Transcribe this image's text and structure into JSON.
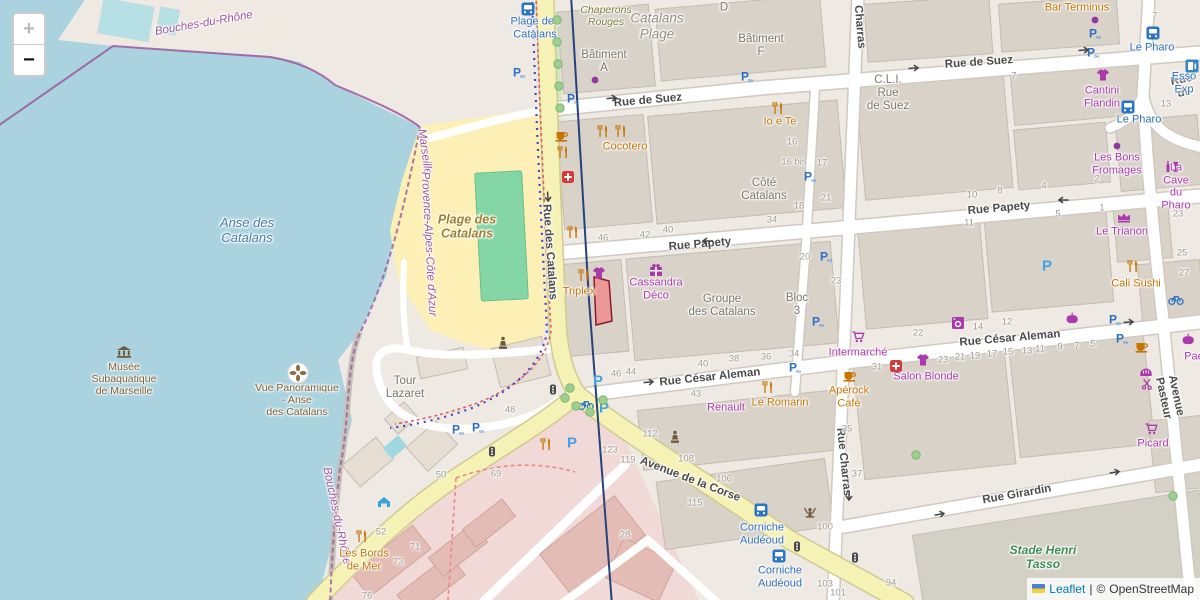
{
  "controls": {
    "zoom_in": "+",
    "zoom_out": "−"
  },
  "attribution": {
    "leaflet": "Leaflet",
    "separator": "|",
    "copyright": "©",
    "osm": "OpenStreetMap"
  },
  "colors": {
    "water": "#aad3df",
    "land": "#eeeae3",
    "building": "#d8d2c9",
    "beach": "#fdf0b6",
    "pitch": "#85d6a6",
    "road_yellow": "#f6f2b6",
    "road_white": "#ffffff",
    "residential_pink": "#f0d9d6",
    "boundary_purple": "#9b59a0",
    "poi_orange": "#c77400",
    "poi_purple": "#ac39ac",
    "parking_blue": "#2a6fc4",
    "bus_blue": "#2f6fc0",
    "highlight_red": "#e06a6a",
    "stadium_label_green": "#3e8e51"
  },
  "labels": [
    {
      "text": "Rue de Suez",
      "x": 648,
      "y": 101,
      "cls": "st",
      "rot": -5,
      "name": "street-label-rue-de-suez"
    },
    {
      "text": "Rue de Suez",
      "x": 979,
      "y": 63,
      "cls": "st",
      "rot": -4,
      "name": "street-label-rue-de-suez"
    },
    {
      "text": "Rue de",
      "x": 1183,
      "y": 87,
      "cls": "st",
      "rot": -12,
      "name": "street-label-rue-de"
    },
    {
      "text": "Rue Papety",
      "x": 700,
      "y": 245,
      "cls": "st",
      "rot": -5,
      "name": "street-label-rue-papety"
    },
    {
      "text": "Rue Papety",
      "x": 999,
      "y": 209,
      "cls": "st",
      "rot": -5,
      "name": "street-label-rue-papety"
    },
    {
      "text": "Rue César Aleman",
      "x": 710,
      "y": 378,
      "cls": "st",
      "rot": -6,
      "name": "street-label-rue-cesar-aleman"
    },
    {
      "text": "Rue César Aleman",
      "x": 1010,
      "y": 339,
      "cls": "st",
      "rot": -5,
      "name": "street-label-rue-cesar-aleman"
    },
    {
      "text": "Rue Girardin",
      "x": 1017,
      "y": 495,
      "cls": "st",
      "rot": -10,
      "name": "street-label-rue-girardin"
    },
    {
      "text": "Avenue de la Corse",
      "x": 690,
      "y": 480,
      "cls": "st",
      "rot": 21,
      "name": "street-label-avenue-de-la-corse"
    },
    {
      "text": "Rue des Catalans",
      "x": 549,
      "y": 252,
      "cls": "st",
      "rot": 86,
      "name": "street-label-rue-des-catalans"
    },
    {
      "text": "Rue Charras",
      "x": 843,
      "y": 462,
      "cls": "st",
      "rot": 84,
      "name": "street-label-rue-charras"
    },
    {
      "text": "Charras",
      "x": 859,
      "y": 27,
      "cls": "st",
      "rot": 85,
      "name": "street-label-charras"
    },
    {
      "text": "Avenue Pasteur",
      "x": 1169,
      "y": 397,
      "cls": "st",
      "rot": 78,
      "name": "street-label-avenue-pasteur"
    },
    {
      "text": "Plage des\nCatalans",
      "x": 535,
      "y": 28,
      "cls": "bus",
      "name": "bus-stop-label"
    },
    {
      "text": "Le Pharo",
      "x": 1152,
      "y": 48,
      "cls": "bus",
      "name": "bus-stop-label"
    },
    {
      "text": "Le Pharo",
      "x": 1139,
      "y": 120,
      "cls": "bus",
      "name": "bus-stop-label"
    },
    {
      "text": "Esso Exp",
      "x": 1184,
      "y": 83,
      "cls": "bus",
      "name": "fuel-station-label"
    },
    {
      "text": "Corniche\nAudéoud",
      "x": 762,
      "y": 534,
      "cls": "bus",
      "name": "bus-stop-label"
    },
    {
      "text": "Corniche\nAudéoud",
      "x": 780,
      "y": 577,
      "cls": "bus",
      "name": "bus-stop-label"
    },
    {
      "text": "Anse des\nCatalans",
      "x": 247,
      "y": 231,
      "cls": "wat",
      "name": "water-label"
    },
    {
      "text": "Bouches-du-Rhône",
      "x": 204,
      "y": 24,
      "cls": "bnd",
      "rot": -10,
      "name": "boundary-label"
    },
    {
      "text": "Marseille",
      "x": 424,
      "y": 152,
      "cls": "bnd",
      "rot": 82,
      "name": "boundary-label"
    },
    {
      "text": "Provence-Alpes-Côte d'Azur",
      "x": 428,
      "y": 244,
      "cls": "bnd",
      "rot": 87,
      "name": "boundary-label"
    },
    {
      "text": "Bouches-du-Rhône",
      "x": 336,
      "y": 516,
      "cls": "bnd",
      "rot": 78,
      "name": "boundary-label"
    },
    {
      "text": "Plage des\nCatalans",
      "x": 467,
      "y": 227,
      "cls": "bch",
      "name": "beach-label"
    },
    {
      "text": "Catalans\nPlage",
      "x": 657,
      "y": 26,
      "cls": "area",
      "name": "area-label"
    },
    {
      "text": "Chaperons\nRouges",
      "x": 606,
      "y": 16,
      "cls": "olv",
      "name": "area-label"
    },
    {
      "text": "Stade Henri\nTasso",
      "x": 1043,
      "y": 558,
      "cls": "grn",
      "name": "stadium-label"
    },
    {
      "text": "Bâtiment\nA",
      "x": 604,
      "y": 62,
      "cls": "bld",
      "name": "building-label"
    },
    {
      "text": "Bâtiment\nF",
      "x": 761,
      "y": 46,
      "cls": "bld",
      "name": "building-label"
    },
    {
      "text": "D",
      "x": 724,
      "y": 8,
      "cls": "bld",
      "name": "building-label"
    },
    {
      "text": "Côté\nCatalans",
      "x": 764,
      "y": 190,
      "cls": "bld",
      "name": "building-label"
    },
    {
      "text": "C.L.I.\nRue\nde Suez",
      "x": 888,
      "y": 94,
      "cls": "bld",
      "name": "building-label"
    },
    {
      "text": "Groupe\ndes Catalans",
      "x": 722,
      "y": 306,
      "cls": "bld",
      "name": "building-label"
    },
    {
      "text": "Bloc\n3",
      "x": 797,
      "y": 305,
      "cls": "bld",
      "name": "building-label"
    },
    {
      "text": "Tour\nLazaret",
      "x": 405,
      "y": 388,
      "cls": "bld",
      "name": "building-label"
    },
    {
      "text": "Musée\nSubaquatique\nde Marseille",
      "x": 124,
      "y": 379,
      "cls": "brw",
      "name": "museum-label"
    },
    {
      "text": "Vue Panoramique\n- Anse\ndes Catalans",
      "x": 297,
      "y": 400,
      "cls": "brw",
      "name": "viewpoint-label"
    },
    {
      "text": "Cocotero",
      "x": 625,
      "y": 147,
      "cls": "po",
      "name": "poi-label"
    },
    {
      "text": "Io e Te",
      "x": 780,
      "y": 122,
      "cls": "po",
      "name": "poi-label"
    },
    {
      "text": "Bar Terminus",
      "x": 1077,
      "y": 8,
      "cls": "po",
      "name": "poi-label"
    },
    {
      "text": "Triplex",
      "x": 579,
      "y": 292,
      "cls": "po",
      "name": "poi-label"
    },
    {
      "text": "Le Romarin",
      "x": 780,
      "y": 403,
      "cls": "po",
      "name": "poi-label"
    },
    {
      "text": "Apérock\nCafé",
      "x": 849,
      "y": 397,
      "cls": "po",
      "name": "poi-label"
    },
    {
      "text": "Les Bords\nde Mer",
      "x": 364,
      "y": 560,
      "cls": "po",
      "name": "poi-label"
    },
    {
      "text": "Cali Sushi",
      "x": 1136,
      "y": 284,
      "cls": "po",
      "name": "poi-label"
    },
    {
      "text": "Cantini\nFlandin",
      "x": 1102,
      "y": 97,
      "cls": "pp",
      "name": "poi-label"
    },
    {
      "text": "Les Bons\nFromages",
      "x": 1117,
      "y": 164,
      "cls": "pp",
      "name": "poi-label"
    },
    {
      "text": "La Cave\ndu Pharo",
      "x": 1176,
      "y": 187,
      "cls": "pp",
      "name": "poi-label"
    },
    {
      "text": "Le Trianon",
      "x": 1122,
      "y": 232,
      "cls": "pp",
      "name": "poi-label"
    },
    {
      "text": "Cassandra\nDéco",
      "x": 656,
      "y": 289,
      "cls": "pp",
      "name": "poi-label"
    },
    {
      "text": "Intermarché",
      "x": 858,
      "y": 353,
      "cls": "pp",
      "name": "poi-label"
    },
    {
      "text": "Salon Blonde",
      "x": 926,
      "y": 377,
      "cls": "pp",
      "name": "poi-label"
    },
    {
      "text": "Renault",
      "x": 726,
      "y": 408,
      "cls": "pp",
      "name": "poi-label"
    },
    {
      "text": "Picard",
      "x": 1153,
      "y": 444,
      "cls": "pp",
      "name": "poi-label"
    },
    {
      "text": "Paé",
      "x": 1194,
      "y": 357,
      "cls": "pp",
      "name": "poi-label"
    },
    {
      "text": "46",
      "x": 603,
      "y": 239,
      "cls": "num"
    },
    {
      "text": "42",
      "x": 645,
      "y": 236,
      "cls": "num"
    },
    {
      "text": "40",
      "x": 668,
      "y": 231,
      "cls": "num"
    },
    {
      "text": "34",
      "x": 772,
      "y": 221,
      "cls": "num"
    },
    {
      "text": "16",
      "x": 792,
      "y": 143,
      "cls": "num"
    },
    {
      "text": "16 bis",
      "x": 794,
      "y": 163,
      "cls": "num"
    },
    {
      "text": "17",
      "x": 822,
      "y": 164,
      "cls": "num"
    },
    {
      "text": "18",
      "x": 799,
      "y": 207,
      "cls": "num"
    },
    {
      "text": "21",
      "x": 826,
      "y": 199,
      "cls": "num"
    },
    {
      "text": "20",
      "x": 805,
      "y": 258,
      "cls": "num"
    },
    {
      "text": "23",
      "x": 836,
      "y": 282,
      "cls": "num"
    },
    {
      "text": "10",
      "x": 972,
      "y": 196,
      "cls": "num"
    },
    {
      "text": "8",
      "x": 1000,
      "y": 192,
      "cls": "num"
    },
    {
      "text": "4",
      "x": 1044,
      "y": 187,
      "cls": "num"
    },
    {
      "text": "2",
      "x": 1097,
      "y": 180,
      "cls": "num"
    },
    {
      "text": "1",
      "x": 1102,
      "y": 209,
      "cls": "num"
    },
    {
      "text": "5",
      "x": 1058,
      "y": 215,
      "cls": "num"
    },
    {
      "text": "11",
      "x": 969,
      "y": 224,
      "cls": "num"
    },
    {
      "text": "23",
      "x": 1178,
      "y": 215,
      "cls": "num"
    },
    {
      "text": "25",
      "x": 1182,
      "y": 254,
      "cls": "num"
    },
    {
      "text": "27",
      "x": 1184,
      "y": 274,
      "cls": "num"
    },
    {
      "text": "7",
      "x": 1014,
      "y": 77,
      "cls": "num"
    },
    {
      "text": "7",
      "x": 1155,
      "y": 17,
      "cls": "num"
    },
    {
      "text": "13",
      "x": 1166,
      "y": 105,
      "cls": "num"
    },
    {
      "text": "22",
      "x": 918,
      "y": 334,
      "cls": "num"
    },
    {
      "text": "14",
      "x": 978,
      "y": 328,
      "cls": "num"
    },
    {
      "text": "12",
      "x": 1007,
      "y": 323,
      "cls": "num"
    },
    {
      "text": "31",
      "x": 877,
      "y": 368,
      "cls": "num"
    },
    {
      "text": "23",
      "x": 943,
      "y": 361,
      "cls": "num"
    },
    {
      "text": "21",
      "x": 960,
      "y": 358,
      "cls": "num"
    },
    {
      "text": "19",
      "x": 975,
      "y": 357,
      "cls": "num"
    },
    {
      "text": "17",
      "x": 992,
      "y": 355,
      "cls": "num"
    },
    {
      "text": "15",
      "x": 1008,
      "y": 353,
      "cls": "num"
    },
    {
      "text": "13",
      "x": 1027,
      "y": 352,
      "cls": "num"
    },
    {
      "text": "11",
      "x": 1040,
      "y": 350,
      "cls": "num"
    },
    {
      "text": "9",
      "x": 1060,
      "y": 348,
      "cls": "num"
    },
    {
      "text": "7",
      "x": 1077,
      "y": 347,
      "cls": "num"
    },
    {
      "text": "5",
      "x": 1093,
      "y": 345,
      "cls": "num"
    },
    {
      "text": "46",
      "x": 616,
      "y": 375,
      "cls": "num"
    },
    {
      "text": "44",
      "x": 631,
      "y": 373,
      "cls": "num"
    },
    {
      "text": "40",
      "x": 703,
      "y": 365,
      "cls": "num"
    },
    {
      "text": "38",
      "x": 734,
      "y": 360,
      "cls": "num"
    },
    {
      "text": "36",
      "x": 766,
      "y": 358,
      "cls": "num"
    },
    {
      "text": "34",
      "x": 794,
      "y": 355,
      "cls": "num"
    },
    {
      "text": "43",
      "x": 696,
      "y": 395,
      "cls": "num"
    },
    {
      "text": "112",
      "x": 650,
      "y": 435,
      "cls": "num"
    },
    {
      "text": "108",
      "x": 686,
      "y": 460,
      "cls": "num"
    },
    {
      "text": "106",
      "x": 724,
      "y": 480,
      "cls": "num"
    },
    {
      "text": "123",
      "x": 610,
      "y": 451,
      "cls": "num"
    },
    {
      "text": "119",
      "x": 628,
      "y": 461,
      "cls": "num"
    },
    {
      "text": "115",
      "x": 695,
      "y": 504,
      "cls": "num"
    },
    {
      "text": "28",
      "x": 625,
      "y": 536,
      "cls": "num"
    },
    {
      "text": "100",
      "x": 825,
      "y": 528,
      "cls": "num"
    },
    {
      "text": "103",
      "x": 825,
      "y": 585,
      "cls": "num"
    },
    {
      "text": "101",
      "x": 838,
      "y": 594,
      "cls": "num"
    },
    {
      "text": "94",
      "x": 891,
      "y": 584,
      "cls": "num"
    },
    {
      "text": "35",
      "x": 847,
      "y": 430,
      "cls": "num"
    },
    {
      "text": "37",
      "x": 857,
      "y": 475,
      "cls": "num"
    },
    {
      "text": "48",
      "x": 510,
      "y": 411,
      "cls": "num"
    },
    {
      "text": "50",
      "x": 441,
      "y": 476,
      "cls": "num"
    },
    {
      "text": "69",
      "x": 496,
      "y": 475,
      "cls": "num"
    },
    {
      "text": "52",
      "x": 381,
      "y": 533,
      "cls": "num"
    },
    {
      "text": "71",
      "x": 415,
      "y": 548,
      "cls": "num"
    },
    {
      "text": "73",
      "x": 398,
      "y": 563,
      "cls": "num"
    },
    {
      "text": "76",
      "x": 367,
      "y": 597,
      "cls": "num"
    }
  ],
  "icons": [
    {
      "name": "bus-stop",
      "x": 528,
      "y": 9
    },
    {
      "name": "bus-stop",
      "x": 1153,
      "y": 33
    },
    {
      "name": "bus-stop",
      "x": 1128,
      "y": 107
    },
    {
      "name": "bus-stop",
      "x": 761,
      "y": 510
    },
    {
      "name": "bus-stop",
      "x": 779,
      "y": 556
    },
    {
      "name": "fuel",
      "x": 1192,
      "y": 66
    },
    {
      "name": "parking",
      "x": 519,
      "y": 73
    },
    {
      "name": "parking",
      "x": 573,
      "y": 99
    },
    {
      "name": "parking",
      "x": 747,
      "y": 77
    },
    {
      "name": "parking",
      "x": 1095,
      "y": 34
    },
    {
      "name": "parking",
      "x": 1093,
      "y": 53
    },
    {
      "name": "parking",
      "x": 810,
      "y": 177
    },
    {
      "name": "parking",
      "x": 826,
      "y": 257
    },
    {
      "name": "parking",
      "x": 818,
      "y": 322
    },
    {
      "name": "parking",
      "x": 795,
      "y": 368
    },
    {
      "name": "parking",
      "x": 458,
      "y": 430
    },
    {
      "name": "parking",
      "x": 478,
      "y": 428
    },
    {
      "name": "parking",
      "x": 1115,
      "y": 320
    },
    {
      "name": "parking",
      "x": 1122,
      "y": 339
    },
    {
      "name": "street-parking",
      "x": 598,
      "y": 381
    },
    {
      "name": "street-parking",
      "x": 604,
      "y": 408
    },
    {
      "name": "street-parking",
      "x": 572,
      "y": 443
    },
    {
      "name": "street-parking",
      "x": 1047,
      "y": 266
    },
    {
      "name": "restaurant",
      "x": 603,
      "y": 131
    },
    {
      "name": "restaurant",
      "x": 621,
      "y": 131
    },
    {
      "name": "restaurant",
      "x": 563,
      "y": 152
    },
    {
      "name": "restaurant",
      "x": 573,
      "y": 232
    },
    {
      "name": "restaurant",
      "x": 584,
      "y": 275
    },
    {
      "name": "restaurant",
      "x": 778,
      "y": 108
    },
    {
      "name": "restaurant",
      "x": 768,
      "y": 387
    },
    {
      "name": "restaurant",
      "x": 362,
      "y": 536
    },
    {
      "name": "restaurant",
      "x": 1133,
      "y": 266
    },
    {
      "name": "restaurant",
      "x": 546,
      "y": 444
    },
    {
      "name": "cafe",
      "x": 562,
      "y": 136
    },
    {
      "name": "cafe",
      "x": 850,
      "y": 376
    },
    {
      "name": "cafe",
      "x": 1142,
      "y": 347
    },
    {
      "name": "pharmacy",
      "x": 568,
      "y": 177
    },
    {
      "name": "pharmacy",
      "x": 896,
      "y": 366
    },
    {
      "name": "museum",
      "x": 124,
      "y": 352
    },
    {
      "name": "viewpoint",
      "x": 298,
      "y": 373
    },
    {
      "name": "gift",
      "x": 656,
      "y": 270
    },
    {
      "name": "clothes",
      "x": 599,
      "y": 273
    },
    {
      "name": "clothes",
      "x": 1103,
      "y": 75
    },
    {
      "name": "clothes",
      "x": 923,
      "y": 360
    },
    {
      "name": "laundry",
      "x": 958,
      "y": 323
    },
    {
      "name": "greengrocer",
      "x": 1072,
      "y": 318
    },
    {
      "name": "greengrocer",
      "x": 1188,
      "y": 339
    },
    {
      "name": "bakery",
      "x": 1146,
      "y": 372
    },
    {
      "name": "hairdresser",
      "x": 1147,
      "y": 384
    },
    {
      "name": "cart",
      "x": 858,
      "y": 337
    },
    {
      "name": "cart",
      "x": 1151,
      "y": 429
    },
    {
      "name": "wine",
      "x": 1172,
      "y": 166
    },
    {
      "name": "theatre",
      "x": 1124,
      "y": 218
    },
    {
      "name": "poi-dot",
      "x": 1095,
      "y": 20
    },
    {
      "name": "poi-dot",
      "x": 1117,
      "y": 146
    },
    {
      "name": "poi-dot",
      "x": 595,
      "y": 80
    },
    {
      "name": "statue",
      "x": 503,
      "y": 343
    },
    {
      "name": "statue",
      "x": 675,
      "y": 437
    },
    {
      "name": "fountain",
      "x": 810,
      "y": 513
    },
    {
      "name": "traffic-light",
      "x": 553,
      "y": 390
    },
    {
      "name": "traffic-light",
      "x": 797,
      "y": 547
    },
    {
      "name": "traffic-light",
      "x": 855,
      "y": 558
    },
    {
      "name": "traffic-light",
      "x": 492,
      "y": 452
    },
    {
      "name": "bicycle",
      "x": 586,
      "y": 405
    },
    {
      "name": "bicycle",
      "x": 1176,
      "y": 300
    },
    {
      "name": "shelter",
      "x": 384,
      "y": 502
    },
    {
      "name": "oneway",
      "x": 613,
      "y": 98,
      "rot": -5
    },
    {
      "name": "oneway",
      "x": 915,
      "y": 68,
      "rot": -4
    },
    {
      "name": "oneway",
      "x": 1085,
      "y": 50,
      "rot": -4
    },
    {
      "name": "oneway",
      "x": 706,
      "y": 241,
      "rot": 180
    },
    {
      "name": "oneway",
      "x": 1062,
      "y": 200,
      "rot": 180
    },
    {
      "name": "oneway",
      "x": 650,
      "y": 382,
      "rot": -6
    },
    {
      "name": "oneway",
      "x": 1130,
      "y": 322,
      "rot": -4
    },
    {
      "name": "oneway",
      "x": 1116,
      "y": 472,
      "rot": -10
    },
    {
      "name": "oneway",
      "x": 941,
      "y": 514,
      "rot": -10
    },
    {
      "name": "oneway",
      "x": 849,
      "y": 497,
      "rot": 92
    },
    {
      "name": "oneway",
      "x": 548,
      "y": 198,
      "rot": 86
    },
    {
      "name": "tree",
      "x": 557,
      "y": 20
    },
    {
      "name": "tree",
      "x": 557,
      "y": 42
    },
    {
      "name": "tree",
      "x": 558,
      "y": 64
    },
    {
      "name": "tree",
      "x": 559,
      "y": 86
    },
    {
      "name": "tree",
      "x": 560,
      "y": 108
    },
    {
      "name": "tree",
      "x": 565,
      "y": 398
    },
    {
      "name": "tree",
      "x": 576,
      "y": 406
    },
    {
      "name": "tree",
      "x": 590,
      "y": 412
    },
    {
      "name": "tree",
      "x": 603,
      "y": 400
    },
    {
      "name": "tree",
      "x": 570,
      "y": 388
    },
    {
      "name": "tree",
      "x": 916,
      "y": 455
    },
    {
      "name": "tree",
      "x": 1173,
      "y": 496
    }
  ]
}
